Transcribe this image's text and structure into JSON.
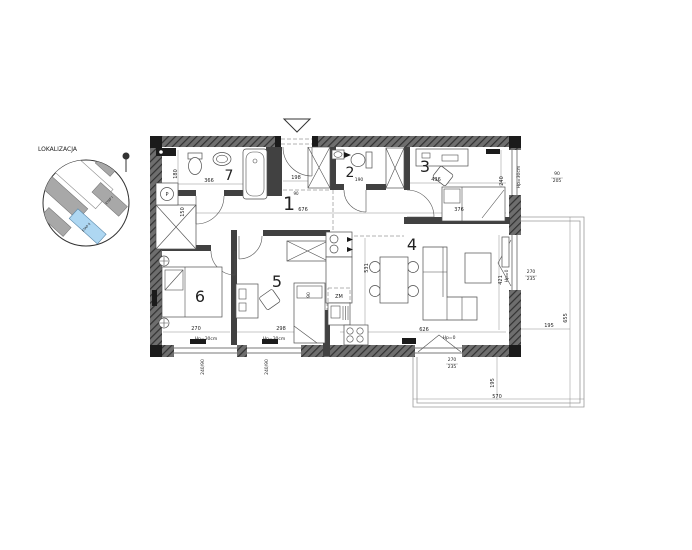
{
  "colors": {
    "wall": "#4a4a4a",
    "line": "#555555",
    "highlight_building": "#aed7f2",
    "building_gray": "#a8a8a8"
  },
  "location_inset": {
    "title": "LOKALIZACJA",
    "buildings": [
      {
        "label": "ETAP I",
        "x": 110,
        "y": 201,
        "rotate": -48,
        "size": 3.2
      },
      {
        "label": "ETAP II",
        "x": 87,
        "y": 228,
        "rotate": -48,
        "size": 3.2
      }
    ]
  },
  "plan": {
    "rooms": [
      {
        "number": "1",
        "x": 289,
        "y": 210,
        "size": 19
      },
      {
        "number": "2",
        "x": 350,
        "y": 177,
        "size": 14
      },
      {
        "number": "3",
        "x": 425,
        "y": 172,
        "size": 16
      },
      {
        "number": "4",
        "x": 412,
        "y": 250,
        "size": 16
      },
      {
        "number": "5",
        "x": 277,
        "y": 287,
        "size": 16
      },
      {
        "number": "6",
        "x": 200,
        "y": 302,
        "size": 16
      },
      {
        "number": "7",
        "x": 229,
        "y": 180,
        "size": 14
      }
    ],
    "dimension_labels": [
      {
        "text": "366",
        "x": 209,
        "y": 182,
        "size": 5
      },
      {
        "text": "180",
        "x": 177,
        "y": 174,
        "size": 5,
        "rotate": -90
      },
      {
        "text": "150",
        "x": 184,
        "y": 212,
        "size": 5,
        "rotate": -90
      },
      {
        "text": "198",
        "x": 296,
        "y": 179,
        "size": 5
      },
      {
        "text": "676",
        "x": 303,
        "y": 211,
        "size": 5
      },
      {
        "text": "190",
        "x": 359,
        "y": 181,
        "size": 4.5
      },
      {
        "text": "90",
        "x": 296,
        "y": 195,
        "size": 4
      },
      {
        "text": "436",
        "x": 436,
        "y": 181,
        "size": 5
      },
      {
        "text": "240",
        "x": 503,
        "y": 181,
        "size": 5,
        "rotate": -90
      },
      {
        "text": "376",
        "x": 459,
        "y": 211,
        "size": 5
      },
      {
        "text": "531",
        "x": 368,
        "y": 268,
        "size": 5,
        "rotate": -90
      },
      {
        "text": "421",
        "x": 502,
        "y": 280,
        "size": 5,
        "rotate": -90
      },
      {
        "text": "626",
        "x": 424,
        "y": 331,
        "size": 5
      },
      {
        "text": "298",
        "x": 281,
        "y": 330,
        "size": 5
      },
      {
        "text": "270",
        "x": 196,
        "y": 330,
        "size": 5
      },
      {
        "text": "90",
        "x": 310,
        "y": 295,
        "size": 4.5,
        "rotate": -90
      },
      {
        "text": "655",
        "x": 567,
        "y": 318,
        "size": 5,
        "rotate": -90
      },
      {
        "text": "195",
        "x": 549,
        "y": 327,
        "size": 5
      },
      {
        "text": "195",
        "x": 494,
        "y": 383,
        "size": 5,
        "rotate": -90
      },
      {
        "text": "570",
        "x": 497,
        "y": 398,
        "size": 5
      },
      {
        "text": "90",
        "x": 557,
        "y": 175,
        "size": 4.5
      },
      {
        "text": "205",
        "x": 557,
        "y": 182,
        "size": 4.5
      },
      {
        "text": "270",
        "x": 531,
        "y": 273,
        "size": 4.5
      },
      {
        "text": "235",
        "x": 531,
        "y": 280,
        "size": 4.5
      },
      {
        "text": "270",
        "x": 452,
        "y": 361,
        "size": 4.5
      },
      {
        "text": "235",
        "x": 452,
        "y": 368,
        "size": 4.5
      },
      {
        "text": "240/90",
        "x": 204,
        "y": 367,
        "size": 4.5,
        "rotate": -90
      },
      {
        "text": "240/90",
        "x": 268,
        "y": 367,
        "size": 4.5,
        "rotate": -90
      }
    ],
    "annotations": [
      {
        "text": "Hp=30cm",
        "x": 206,
        "y": 340,
        "size": 4.5
      },
      {
        "text": "Hp=30cm",
        "x": 274,
        "y": 340,
        "size": 4.5
      },
      {
        "text": "Hp=0",
        "x": 449,
        "y": 339,
        "size": 4.5
      },
      {
        "text": "Hp=0",
        "x": 508,
        "y": 276,
        "size": 4.5,
        "rotate": -90
      },
      {
        "text": "Hp=30cm",
        "x": 520,
        "y": 177,
        "size": 4.5,
        "rotate": -90
      },
      {
        "text": "ZM",
        "x": 339,
        "y": 298,
        "size": 5
      },
      {
        "text": "P",
        "x": 167,
        "y": 196,
        "size": 5
      }
    ]
  }
}
